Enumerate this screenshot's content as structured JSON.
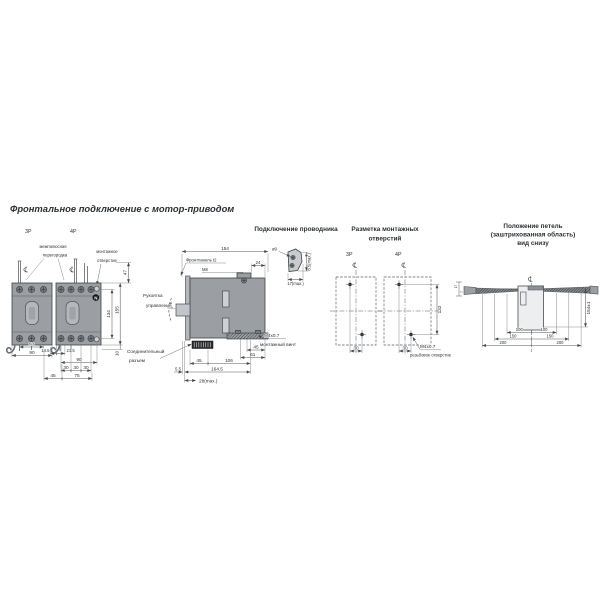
{
  "palette": {
    "background": "#ffffff",
    "body_gray": "#9b9ea2",
    "line": "#4b4e52"
  },
  "front": {
    "title": "Фронтальное подключение с мотор-приводом",
    "pole3": "3P",
    "pole4": "4P",
    "callout_partition_1": "межполюсная",
    "callout_partition_2": "перегородка",
    "callout_hole_1": "монтажное",
    "callout_hole_2": "отверстие",
    "neutral": "N",
    "dim_60": "60",
    "dim_90": "90",
    "dim_14_5": "14.5",
    "dim_21_5": "21.5",
    "dim_90b": "90",
    "dim_30_1": "30",
    "dim_30_2": "30",
    "dim_30_3": "30",
    "dim_45": "45",
    "dim_75": "75",
    "dim_47": "47",
    "dim_134": "134",
    "dim_155": "155",
    "dim_10": "10"
  },
  "side": {
    "dim_154": "154",
    "front_panel": "Фронтпанель t2",
    "bolt": "М8",
    "dim_24": "24",
    "handle_1": "Рукоятка",
    "handle_2": "управления",
    "connector_1": "Соединительный",
    "connector_2": "разъем",
    "screw_1": "М4х0.7",
    "screw_2": "монтажный винт",
    "dim_45_lug": "45",
    "dim_61": "61",
    "dim_45": "45",
    "dim_106": "106",
    "dim_164_5": "164.5",
    "dim_5_5": "5.5",
    "dim_28": "28(max.)"
  },
  "conductor": {
    "title": "Подключение проводника",
    "diameter": "ø9",
    "dim_w": "17(max.)",
    "dim_h": "8.5(max.)"
  },
  "mounting": {
    "title_1": "Разметка монтажных",
    "title_2": "отверстий",
    "pole3": "3P",
    "pole4": "4P",
    "dim_30_1": "30",
    "dim_30_2": "30",
    "dim_132": "132",
    "hole_1": "М4х0.7",
    "hole_2": "резьбовое отверстие"
  },
  "hinge": {
    "title_1": "Положение петель",
    "title_2": "(заштрихованная область)",
    "title_3": "вид снизу",
    "dim_100_1": "100",
    "dim_100_2": "100",
    "dim_150_1": "150",
    "dim_150_2": "150",
    "dim_200_1": "200",
    "dim_200_2": "200",
    "dim_154": "154±1",
    "dim_17": "17",
    "dim_7": "7"
  }
}
